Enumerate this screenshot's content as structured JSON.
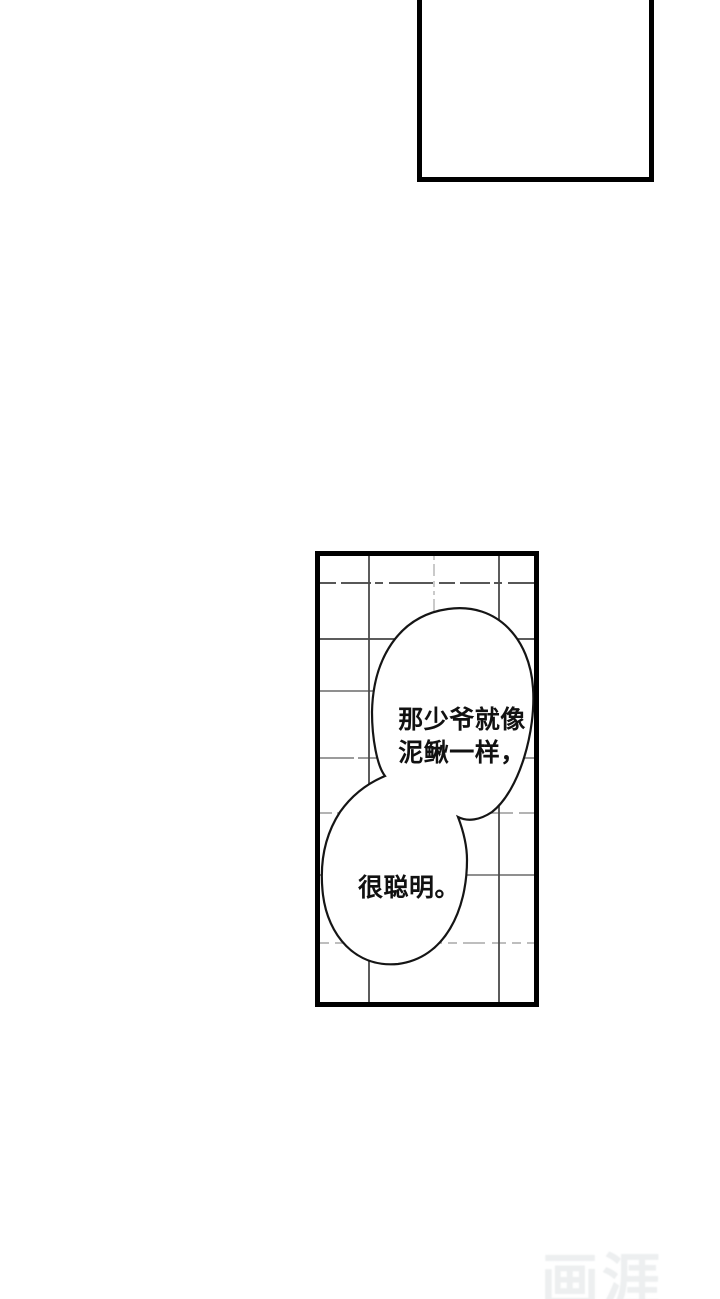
{
  "page": {
    "background_color": "#ffffff",
    "panel_border_color": "#000000",
    "ink_color": "#111111",
    "tile_line_color": "#555555"
  },
  "comic": {
    "bubble1": {
      "line1": "那少爷就像",
      "line2": "泥鳅一样，"
    },
    "bubble2": {
      "text": "很聪明。"
    }
  },
  "watermark": {
    "text": "画涯",
    "color": "#edeff0"
  }
}
